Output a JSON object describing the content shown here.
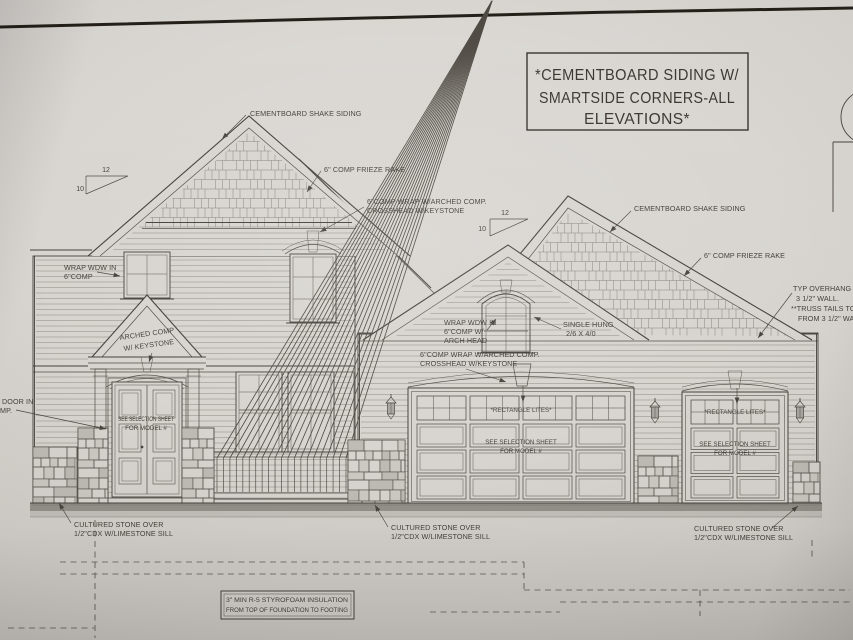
{
  "title_block": {
    "line1": "*CEMENTBOARD SIDING W/",
    "line2": "SMARTSIDE CORNERS-ALL",
    "line3": "ELEVATIONS*"
  },
  "labels": {
    "shake_siding": "CEMENTBOARD SHAKE SIDING",
    "frieze_rake": "6\" COMP FRIEZE RAKE",
    "comp_wrap_line1": "6\"COMP WRAP W/ARCHED COMP.",
    "comp_wrap_line2": "CROSSHEAD W/KEYSTONE",
    "wrap_wdw_line1": "WRAP WDW IN",
    "wrap_wdw_line2": "6\"COMP",
    "wrap_wdw_arch_line1": "WRAP WDW IN",
    "wrap_wdw_arch_line2": "6\"COMP W/",
    "wrap_wdw_arch_line3": "ARCH HEAD",
    "single_hung_line1": "SINGLE HUNG",
    "single_hung_line2": "2/6 X 4/0",
    "arched_comp_line1": "ARCHED COMP",
    "arched_comp_line2": "W/ KEYSTONE",
    "door_in_line1": "DOOR IN",
    "door_in_line2": "MP.",
    "selection_line1": "SEE SELECTION SHEET",
    "selection_line2": "FOR MODEL #",
    "rectangle_lites": "*RECTANGLE LITES*",
    "stone_line1": "CULTURED STONE OVER",
    "stone_line2": "1/2\"CDX W/LIMESTONE SILL",
    "overhang_line1": "TYP OVERHANG 1'-",
    "overhang_line2": "3 1/2\" WALL.",
    "overhang_line3": "**TRUSS TAILS TO",
    "overhang_line4": "FROM 3 1/2\" WA",
    "insulation_line1": "3\" MIN R-5 STYROFOAM INSULATION",
    "insulation_line2": "FROM TOP OF FOUNDATION TO FOOTING",
    "slope_rise": "12",
    "slope_run": "10"
  },
  "colors": {
    "paper": "#d8d5d0",
    "ink": "#4a453f",
    "photo_edge": "#242019",
    "foundation_band": "#8d8984"
  }
}
